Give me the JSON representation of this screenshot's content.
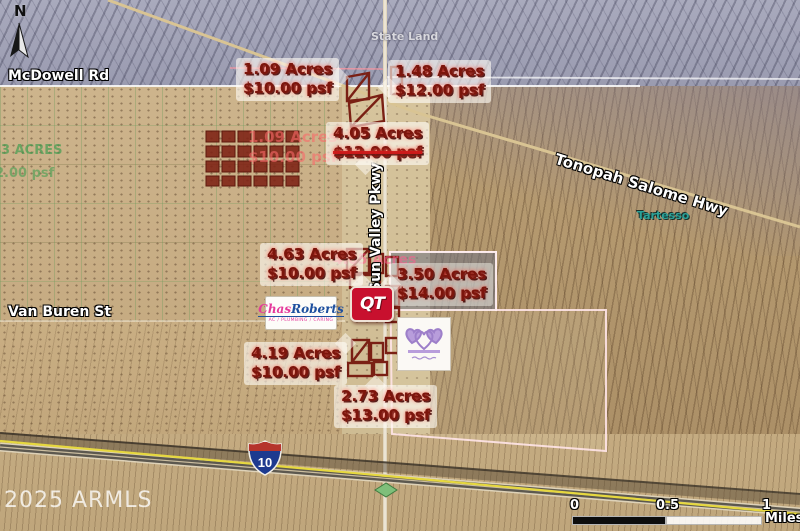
{
  "map": {
    "compass_label": "N",
    "watermark": "2025 ARMLS",
    "roads": {
      "mcdowell": "McDowell Rd",
      "van_buren": "Van Buren St",
      "sun_valley": "Sun Valley Pkwy",
      "tonopah_salome": "Tonopah Salome Hwy"
    },
    "places": {
      "state_land": "State Land",
      "tartesso": "Tartesso"
    },
    "interstate": {
      "number": "10"
    },
    "parcels": [
      {
        "acres": "1.09 Acres",
        "price": "$10.00 psf"
      },
      {
        "acres": "1.48 Acres",
        "price": "$12.00 psf"
      },
      {
        "acres": "4.05 Acres",
        "price": "$12.00 psf",
        "price_struck": true
      },
      {
        "acres": "4.63 Acres",
        "price": "$10.00 psf"
      },
      {
        "acres": "3.50 Acres",
        "price": "$14.00 psf"
      },
      {
        "acres": "4.19 Acres",
        "price": "$10.00 psf"
      },
      {
        "acres": "2.73 Acres",
        "price": "$13.00 psf"
      }
    ],
    "ghost_labels": {
      "acres_1_09": "1.09 Acres",
      "price_10": "$10.00 psf",
      "acres_4_05": "4.05 Acres",
      "acres_43": "43 ACRES",
      "price_2": "2.00 psf"
    },
    "logos": {
      "chas_roberts": {
        "word1": "Chas",
        "word2": "Roberts",
        "tagline": "AC / PLUMBING / CARING"
      },
      "qt": {
        "letters": "QT"
      },
      "heart_crown": {
        "icon": "heart-crown-icon"
      }
    },
    "scale_bar": {
      "tick0": "0",
      "tick_half": "0.5",
      "tick1": "1",
      "unit": "Miles"
    },
    "colors": {
      "annotation_text": "#7c150c",
      "parcel_outline": "#7a2014",
      "boundary_line": "#ffe4e8",
      "qt_red": "#c8102e",
      "chas_pink": "#e5399b",
      "chas_blue": "#1d4f9e",
      "heart_purple": "#a88fd2",
      "tartesso_teal": "#2aa198",
      "shield_blue": "#1d3a8f",
      "shield_red": "#b5342c",
      "highway_yellow": "#e6d83f"
    }
  }
}
